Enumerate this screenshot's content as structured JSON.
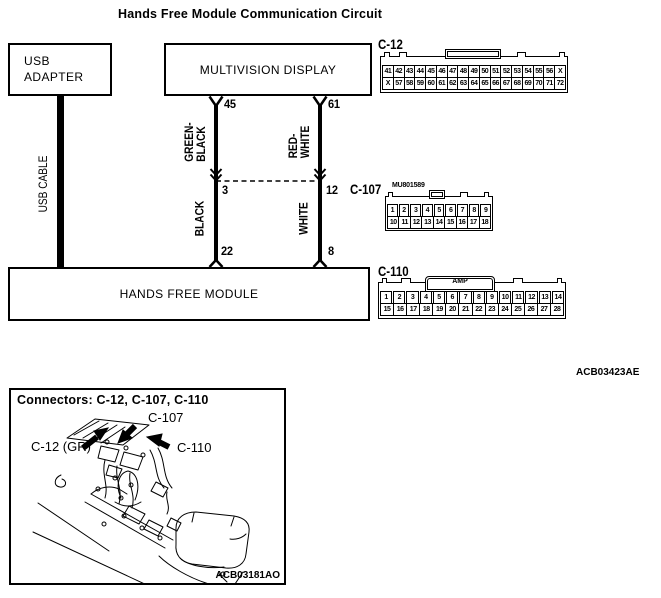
{
  "title": "Hands Free Module Communication Circuit",
  "ref_code": "ACB03423AE",
  "boxes": {
    "usb_adapter": "USB\nADAPTER",
    "multivision_display": "MULTIVISION DISPLAY",
    "hands_free_module": "HANDS FREE MODULE",
    "usb_cable": "USB CABLE"
  },
  "wires": {
    "left": {
      "top_pin": "45",
      "top_color": "GREEN-\nBLACK",
      "mid_pin": "3",
      "bottom_color": "BLACK",
      "bottom_pin": "22"
    },
    "right": {
      "top_pin": "61",
      "top_color": "RED-\nWHITE",
      "mid_pin": "12",
      "bottom_color": "WHITE",
      "bottom_pin": "8"
    }
  },
  "connectors": {
    "c12": {
      "label": "C-12",
      "row1": [
        "41",
        "42",
        "43",
        "44",
        "45",
        "46",
        "47",
        "48",
        "49",
        "50",
        "51",
        "52",
        "53",
        "54",
        "55",
        "56",
        "X"
      ],
      "row2": [
        "X",
        "57",
        "58",
        "59",
        "60",
        "61",
        "62",
        "63",
        "64",
        "65",
        "66",
        "67",
        "68",
        "69",
        "70",
        "71",
        "72"
      ]
    },
    "c107": {
      "label": "C-107",
      "part": "MU801589",
      "row1": [
        "1",
        "2",
        "3",
        "4",
        "5",
        "6",
        "7",
        "8",
        "9"
      ],
      "row2": [
        "10",
        "11",
        "12",
        "13",
        "14",
        "15",
        "16",
        "17",
        "18"
      ]
    },
    "c110": {
      "label": "C-110",
      "brand": "AMP",
      "row1": [
        "1",
        "2",
        "3",
        "4",
        "5",
        "6",
        "7",
        "8",
        "9",
        "10",
        "11",
        "12",
        "13",
        "14"
      ],
      "row2": [
        "15",
        "16",
        "17",
        "18",
        "19",
        "20",
        "21",
        "22",
        "23",
        "24",
        "25",
        "26",
        "27",
        "28"
      ]
    }
  },
  "figure": {
    "title": "Connectors: C-12, C-107, C-110",
    "label_c107": "C-107",
    "label_c12": "C-12 (GR)",
    "label_c110": "C-110",
    "ref_code": "ACB03181AO"
  }
}
